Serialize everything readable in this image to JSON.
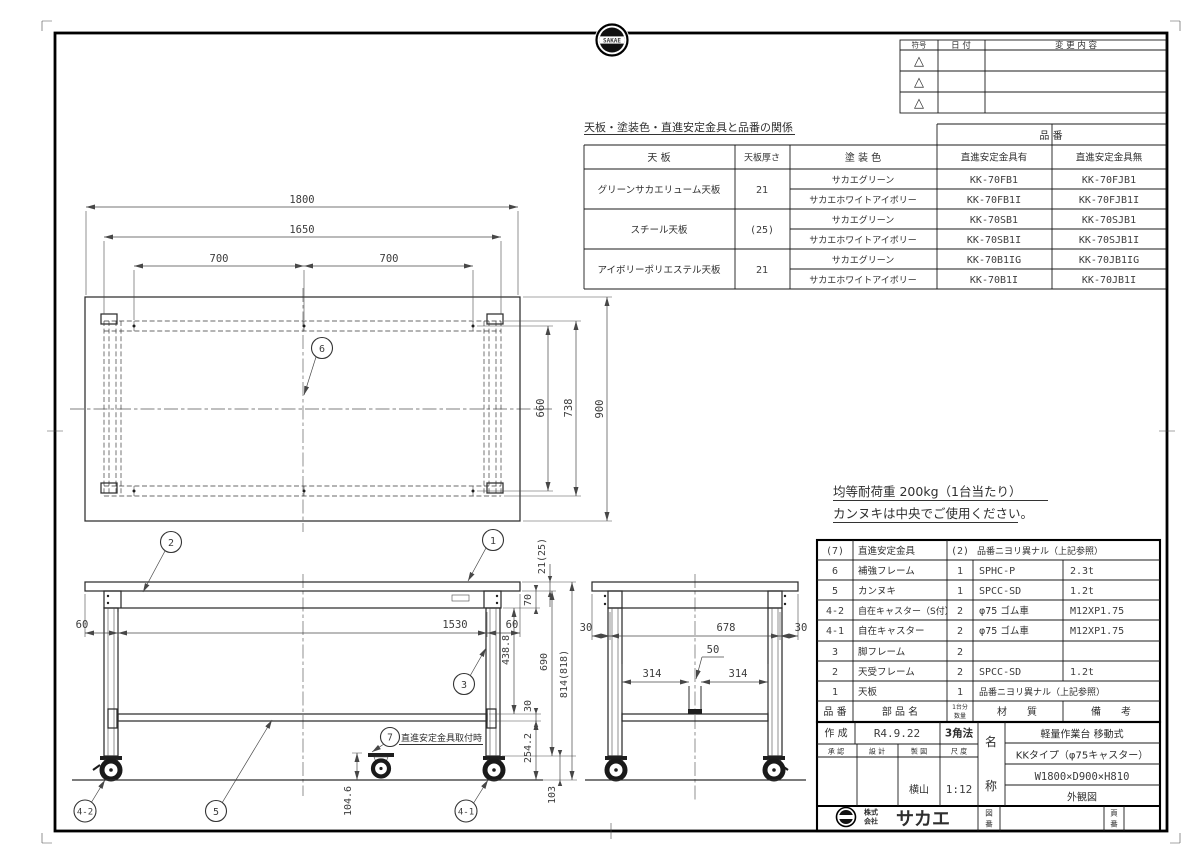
{
  "sheet": {
    "badge_text": "SAKAE"
  },
  "revision_table": {
    "col_symbol": "符号",
    "col_date": "日  付",
    "col_change": "変 更 内 容",
    "marker": "△"
  },
  "relation_table": {
    "title": "天板・塗装色・直進安定金具と品番の関係",
    "part_no": "品  番",
    "col_top": "天  板",
    "col_thickness": "天板厚さ",
    "col_paint": "塗 装 色",
    "col_with": "直進安定金具有",
    "col_without": "直進安定金具無",
    "groups": [
      {
        "top": "グリーンサカエリューム天板",
        "thickness": "21"
      },
      {
        "top": "スチール天板",
        "thickness": "(25)"
      },
      {
        "top": "アイボリーポリエステル天板",
        "thickness": "21"
      }
    ],
    "rows": [
      {
        "paint": "サカエグリーン",
        "with_part": "KK-70FB1",
        "without_part": "KK-70FJB1"
      },
      {
        "paint": "サカエホワイトアイボリー",
        "with_part": "KK-70FB1I",
        "without_part": "KK-70FJB1I"
      },
      {
        "paint": "サカエグリーン",
        "with_part": "KK-70SB1",
        "without_part": "KK-70SJB1"
      },
      {
        "paint": "サカエホワイトアイボリー",
        "with_part": "KK-70SB1I",
        "without_part": "KK-70SJB1I"
      },
      {
        "paint": "サカエグリーン",
        "with_part": "KK-70B1IG",
        "without_part": "KK-70JB1IG"
      },
      {
        "paint": "サカエホワイトアイボリー",
        "with_part": "KK-70B1I",
        "without_part": "KK-70JB1I"
      }
    ]
  },
  "notes": {
    "line1": "均等耐荷重  200kg（1台当たり）",
    "line2": "カンヌキは中央でご使用ください。"
  },
  "parts_table": {
    "header": {
      "no": "品 番",
      "name": "部  品  名",
      "qty1": "1台分",
      "qty2": "数量",
      "material": "材　　質",
      "remarks": "備　　考"
    },
    "rows": [
      {
        "no": "(7)",
        "name": "直進安定金具",
        "qty": "(2)",
        "material": "品番ニヨリ異ナル（上記参照）",
        "remarks": ""
      },
      {
        "no": "6",
        "name": "補強フレーム",
        "qty": "1",
        "material": "SPHC-P",
        "remarks": "2.3t"
      },
      {
        "no": "5",
        "name": "カンヌキ",
        "qty": "1",
        "material": "SPCC-SD",
        "remarks": "1.2t"
      },
      {
        "no": "4-2",
        "name": "自在キャスター（S付）",
        "qty": "2",
        "material": "φ75 ゴム車",
        "remarks": "M12XP1.75"
      },
      {
        "no": "4-1",
        "name": "自在キャスター",
        "qty": "2",
        "material": "φ75 ゴム車",
        "remarks": "M12XP1.75"
      },
      {
        "no": "3",
        "name": "脚フレーム",
        "qty": "2",
        "material": "",
        "remarks": ""
      },
      {
        "no": "2",
        "name": "天受フレーム",
        "qty": "2",
        "material": "SPCC-SD",
        "remarks": "1.2t"
      },
      {
        "no": "1",
        "name": "天板",
        "qty": "1",
        "material": "品番ニヨリ異ナル（上記参照）",
        "remarks": ""
      }
    ]
  },
  "title_block": {
    "created_label": "作 成",
    "created_date": "R4.9.22",
    "projection": "3角法",
    "approval_label": "承 認",
    "design_label": "設 計",
    "draft_label": "製 図",
    "scale_label": "尺 度",
    "drafter": "横山",
    "scale": "1:12",
    "name_label_top": "名",
    "name_label_bottom": "称",
    "product_type": "軽量作業台 移動式",
    "product_series": "KKタイプ（φ75キャスター）",
    "product_size": "W1800×D900×H810",
    "drawing_kind": "外観図",
    "company_prefix_top": "株式",
    "company_prefix_bottom": "会社",
    "company_name": "サカエ",
    "drawing_no_top": "図",
    "drawing_no_bottom": "番",
    "page_no_top": "頁",
    "page_no_bottom": "番"
  },
  "top_view": {
    "dim_width": "1800",
    "dim_inner": "1650",
    "dim_pitch_l": "700",
    "dim_pitch_r": "700",
    "dim_depth": "900",
    "dim_frame": "738",
    "dim_pitch_d": "660"
  },
  "front_view": {
    "dim_oh_l": "60",
    "dim_span": "1530",
    "dim_oh_r": "60",
    "dim_thick": "21(25)",
    "dim_frame_h": "70",
    "dim_438": "438.8",
    "dim_690": "690",
    "dim_30": "30",
    "dim_254": "254.2",
    "dim_total": "814(818)",
    "dim_103": "103",
    "dim_1046": "104.6",
    "stab_note": "直進安定金具取付時"
  },
  "side_view": {
    "dim_oh_l": "30",
    "dim_span": "678",
    "dim_oh_r": "30",
    "dim_pitch_l": "314",
    "dim_pitch_r": "314",
    "dim_50": "50"
  },
  "balloons": {
    "b1": "1",
    "b2": "2",
    "b3": "3",
    "b41": "4-1",
    "b42": "4-2",
    "b5": "5",
    "b6": "6",
    "b7": "7"
  }
}
